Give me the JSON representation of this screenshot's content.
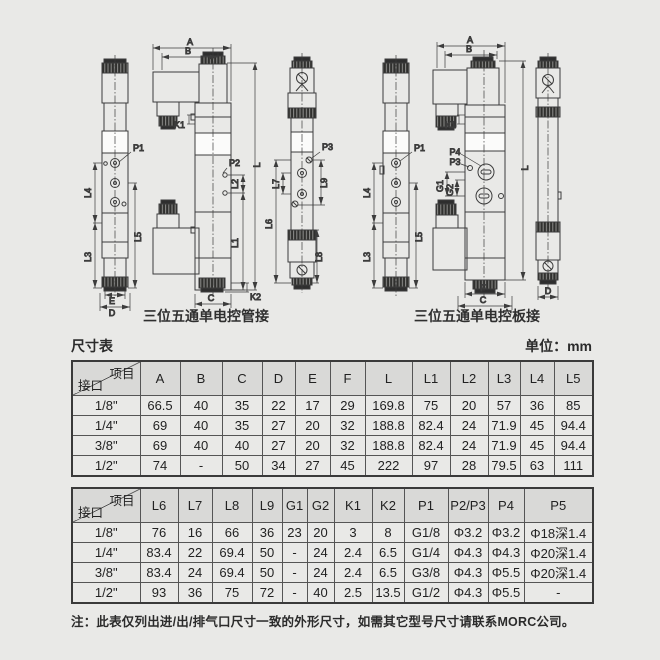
{
  "colors": {
    "background": "#e9e9e7",
    "line": "#3c3c3c",
    "table_header_bg": "#d9d9d7",
    "table_border": "#555555"
  },
  "drawings": {
    "caption_pipe": "三位五通单电控管接",
    "caption_plate": "三位五通单电控板接",
    "labels": {
      "A": "A",
      "B": "B",
      "C": "C",
      "D": "D",
      "E": "E",
      "F": "F",
      "L": "L",
      "L1": "L1",
      "L2": "L2",
      "L3": "L3",
      "L4": "L4",
      "L5": "L5",
      "L6": "L6",
      "L7": "L7",
      "L8": "L8",
      "L9": "L9",
      "K1": "K1",
      "K2": "K2",
      "P1": "P1",
      "P2": "P2",
      "P3": "P3",
      "P4": "P4",
      "G1": "G1",
      "G2": "G2"
    }
  },
  "dim_table": {
    "title": "尺寸表",
    "unit": "单位：mm",
    "corner": {
      "top": "项目",
      "bottom": "接口"
    },
    "table1": {
      "headers": [
        "A",
        "B",
        "C",
        "D",
        "E",
        "F",
        "L",
        "L1",
        "L2",
        "L3",
        "L4",
        "L5"
      ],
      "rows": [
        {
          "port": "1/8\"",
          "values": [
            "66.5",
            "40",
            "35",
            "22",
            "17",
            "29",
            "169.8",
            "75",
            "20",
            "57",
            "36",
            "85"
          ]
        },
        {
          "port": "1/4\"",
          "values": [
            "69",
            "40",
            "35",
            "27",
            "20",
            "32",
            "188.8",
            "82.4",
            "24",
            "71.9",
            "45",
            "94.4"
          ]
        },
        {
          "port": "3/8\"",
          "values": [
            "69",
            "40",
            "40",
            "27",
            "20",
            "32",
            "188.8",
            "82.4",
            "24",
            "71.9",
            "45",
            "94.4"
          ]
        },
        {
          "port": "1/2\"",
          "values": [
            "74",
            "-",
            "50",
            "34",
            "27",
            "45",
            "222",
            "97",
            "28",
            "79.5",
            "63",
            "111"
          ]
        }
      ]
    },
    "table2": {
      "headers": [
        "L6",
        "L7",
        "L8",
        "L9",
        "G1",
        "G2",
        "K1",
        "K2",
        "P1",
        "P2/P3",
        "P4",
        "P5"
      ],
      "rows": [
        {
          "port": "1/8\"",
          "values": [
            "76",
            "16",
            "66",
            "36",
            "23",
            "20",
            "3",
            "8",
            "G1/8",
            "Φ3.2",
            "Φ3.2",
            "Φ18深1.4"
          ]
        },
        {
          "port": "1/4\"",
          "values": [
            "83.4",
            "22",
            "69.4",
            "50",
            "-",
            "24",
            "2.4",
            "6.5",
            "G1/4",
            "Φ4.3",
            "Φ4.3",
            "Φ20深1.4"
          ]
        },
        {
          "port": "3/8\"",
          "values": [
            "83.4",
            "24",
            "69.4",
            "50",
            "-",
            "24",
            "2.4",
            "6.5",
            "G3/8",
            "Φ4.3",
            "Φ5.5",
            "Φ20深1.4"
          ]
        },
        {
          "port": "1/2\"",
          "values": [
            "93",
            "36",
            "75",
            "72",
            "-",
            "40",
            "2.5",
            "13.5",
            "G1/2",
            "Φ4.3",
            "Φ5.5",
            "-"
          ]
        }
      ]
    }
  },
  "note": "注：此表仅列出进/出/排气口尺寸一致的外形尺寸，如需其它型号尺寸请联系MORC公司。"
}
